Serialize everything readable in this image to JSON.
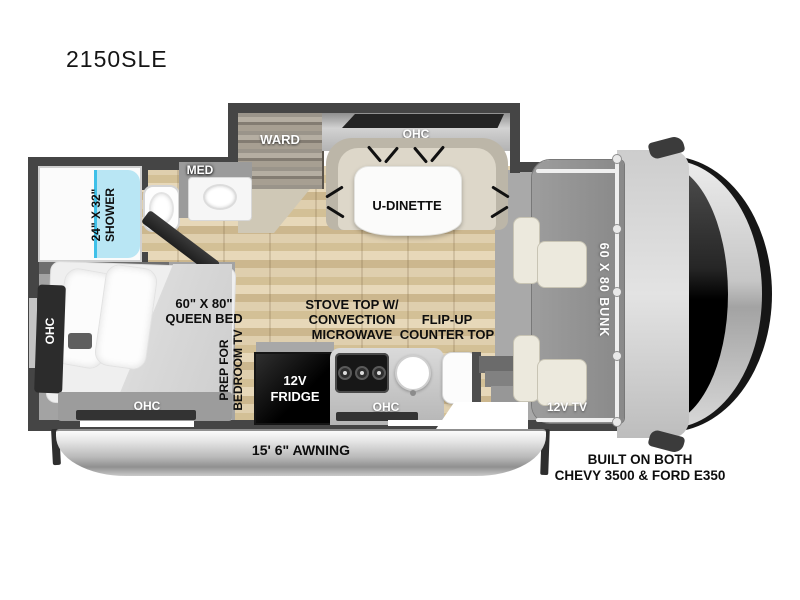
{
  "title": "2150SLE",
  "colors": {
    "wall": "#454545",
    "floor_wood": "#d9c49d",
    "shower_fill": "#b9e6f4",
    "shower_trim": "#3fc0e8",
    "fridge": "#0a0a0a",
    "awning_silver": "#c9c9c9"
  },
  "labels": {
    "ward": "WARD",
    "dinette_ohc": "OHC",
    "dinette_table": "U-DINETTE",
    "med_cabinet": "MED",
    "shower": "24\" X 32\"\nSHOWER",
    "queen_bed": "60\" X 80\"\nQUEEN BED",
    "bedroom_side_ohc": "OHC",
    "bedroom_foot_ohc": "OHC",
    "bedroom_tv_prep": "PREP FOR\nBEDROOM TV",
    "fridge": "12V\nFRIDGE",
    "stove": "STOVE TOP W/\nCONVECTION\nMICROWAVE",
    "flip_counter": "FLIP-UP\nCOUNTER TOP",
    "kitchen_ohc": "OHC",
    "cab_bunk": "60 X 80 BUNK",
    "cab_tv": "12V TV",
    "awning": "15' 6\" AWNING",
    "chassis": "BUILT ON BOTH\nCHEVY 3500 & FORD E350"
  }
}
